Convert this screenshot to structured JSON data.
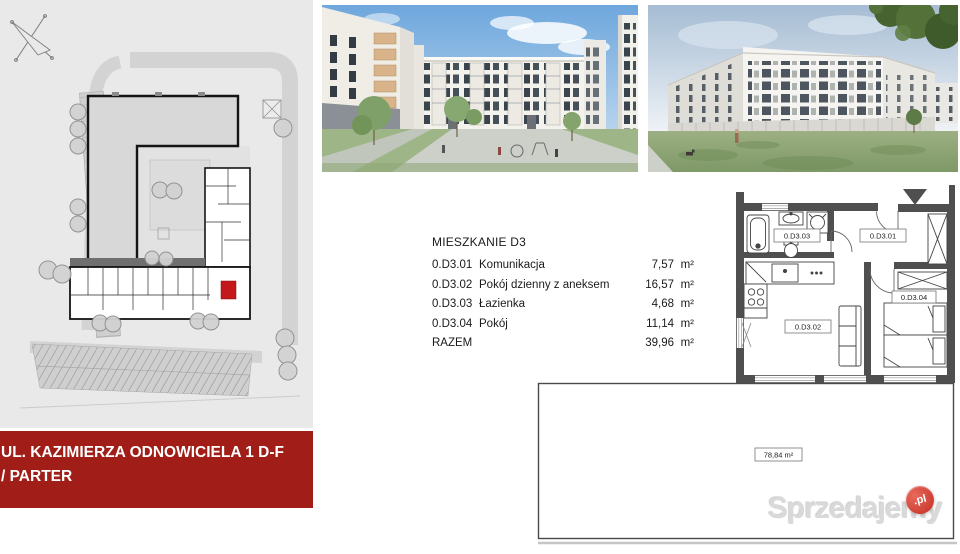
{
  "listing": {
    "title": "MIESZKANIE D3",
    "rows": [
      {
        "code": "0.D3.01",
        "name": "Komunikacja",
        "area": "7,57",
        "unit": "m²"
      },
      {
        "code": "0.D3.02",
        "name": "Pokój dzienny z aneksem",
        "area": "16,57",
        "unit": "m²"
      },
      {
        "code": "0.D3.03",
        "name": "Łazienka",
        "area": "4,68",
        "unit": "m²"
      },
      {
        "code": "0.D3.04",
        "name": "Pokój",
        "area": "11,14",
        "unit": "m²"
      }
    ],
    "total_label": "RAZEM",
    "total_area": "39,96",
    "total_unit": "m²"
  },
  "floor_plan": {
    "labels": {
      "bathroom": "0.D3.03",
      "hall": "0.D3.01",
      "living": "0.D3.02",
      "bedroom": "0.D3.04"
    },
    "garden_label": "78,84 m²"
  },
  "banner": {
    "line1": "UL. KAZIMIERZA ODNOWICIELA 1 D-F",
    "line2": "/ PARTER"
  },
  "watermark": {
    "brand": "Sprzedajemy",
    "tld": ".pl"
  },
  "colors": {
    "banner_bg": "#a01e17",
    "unit_highlight": "#c3171b",
    "wall": "#4f4f4f",
    "watermark_red": "#c52f22"
  }
}
